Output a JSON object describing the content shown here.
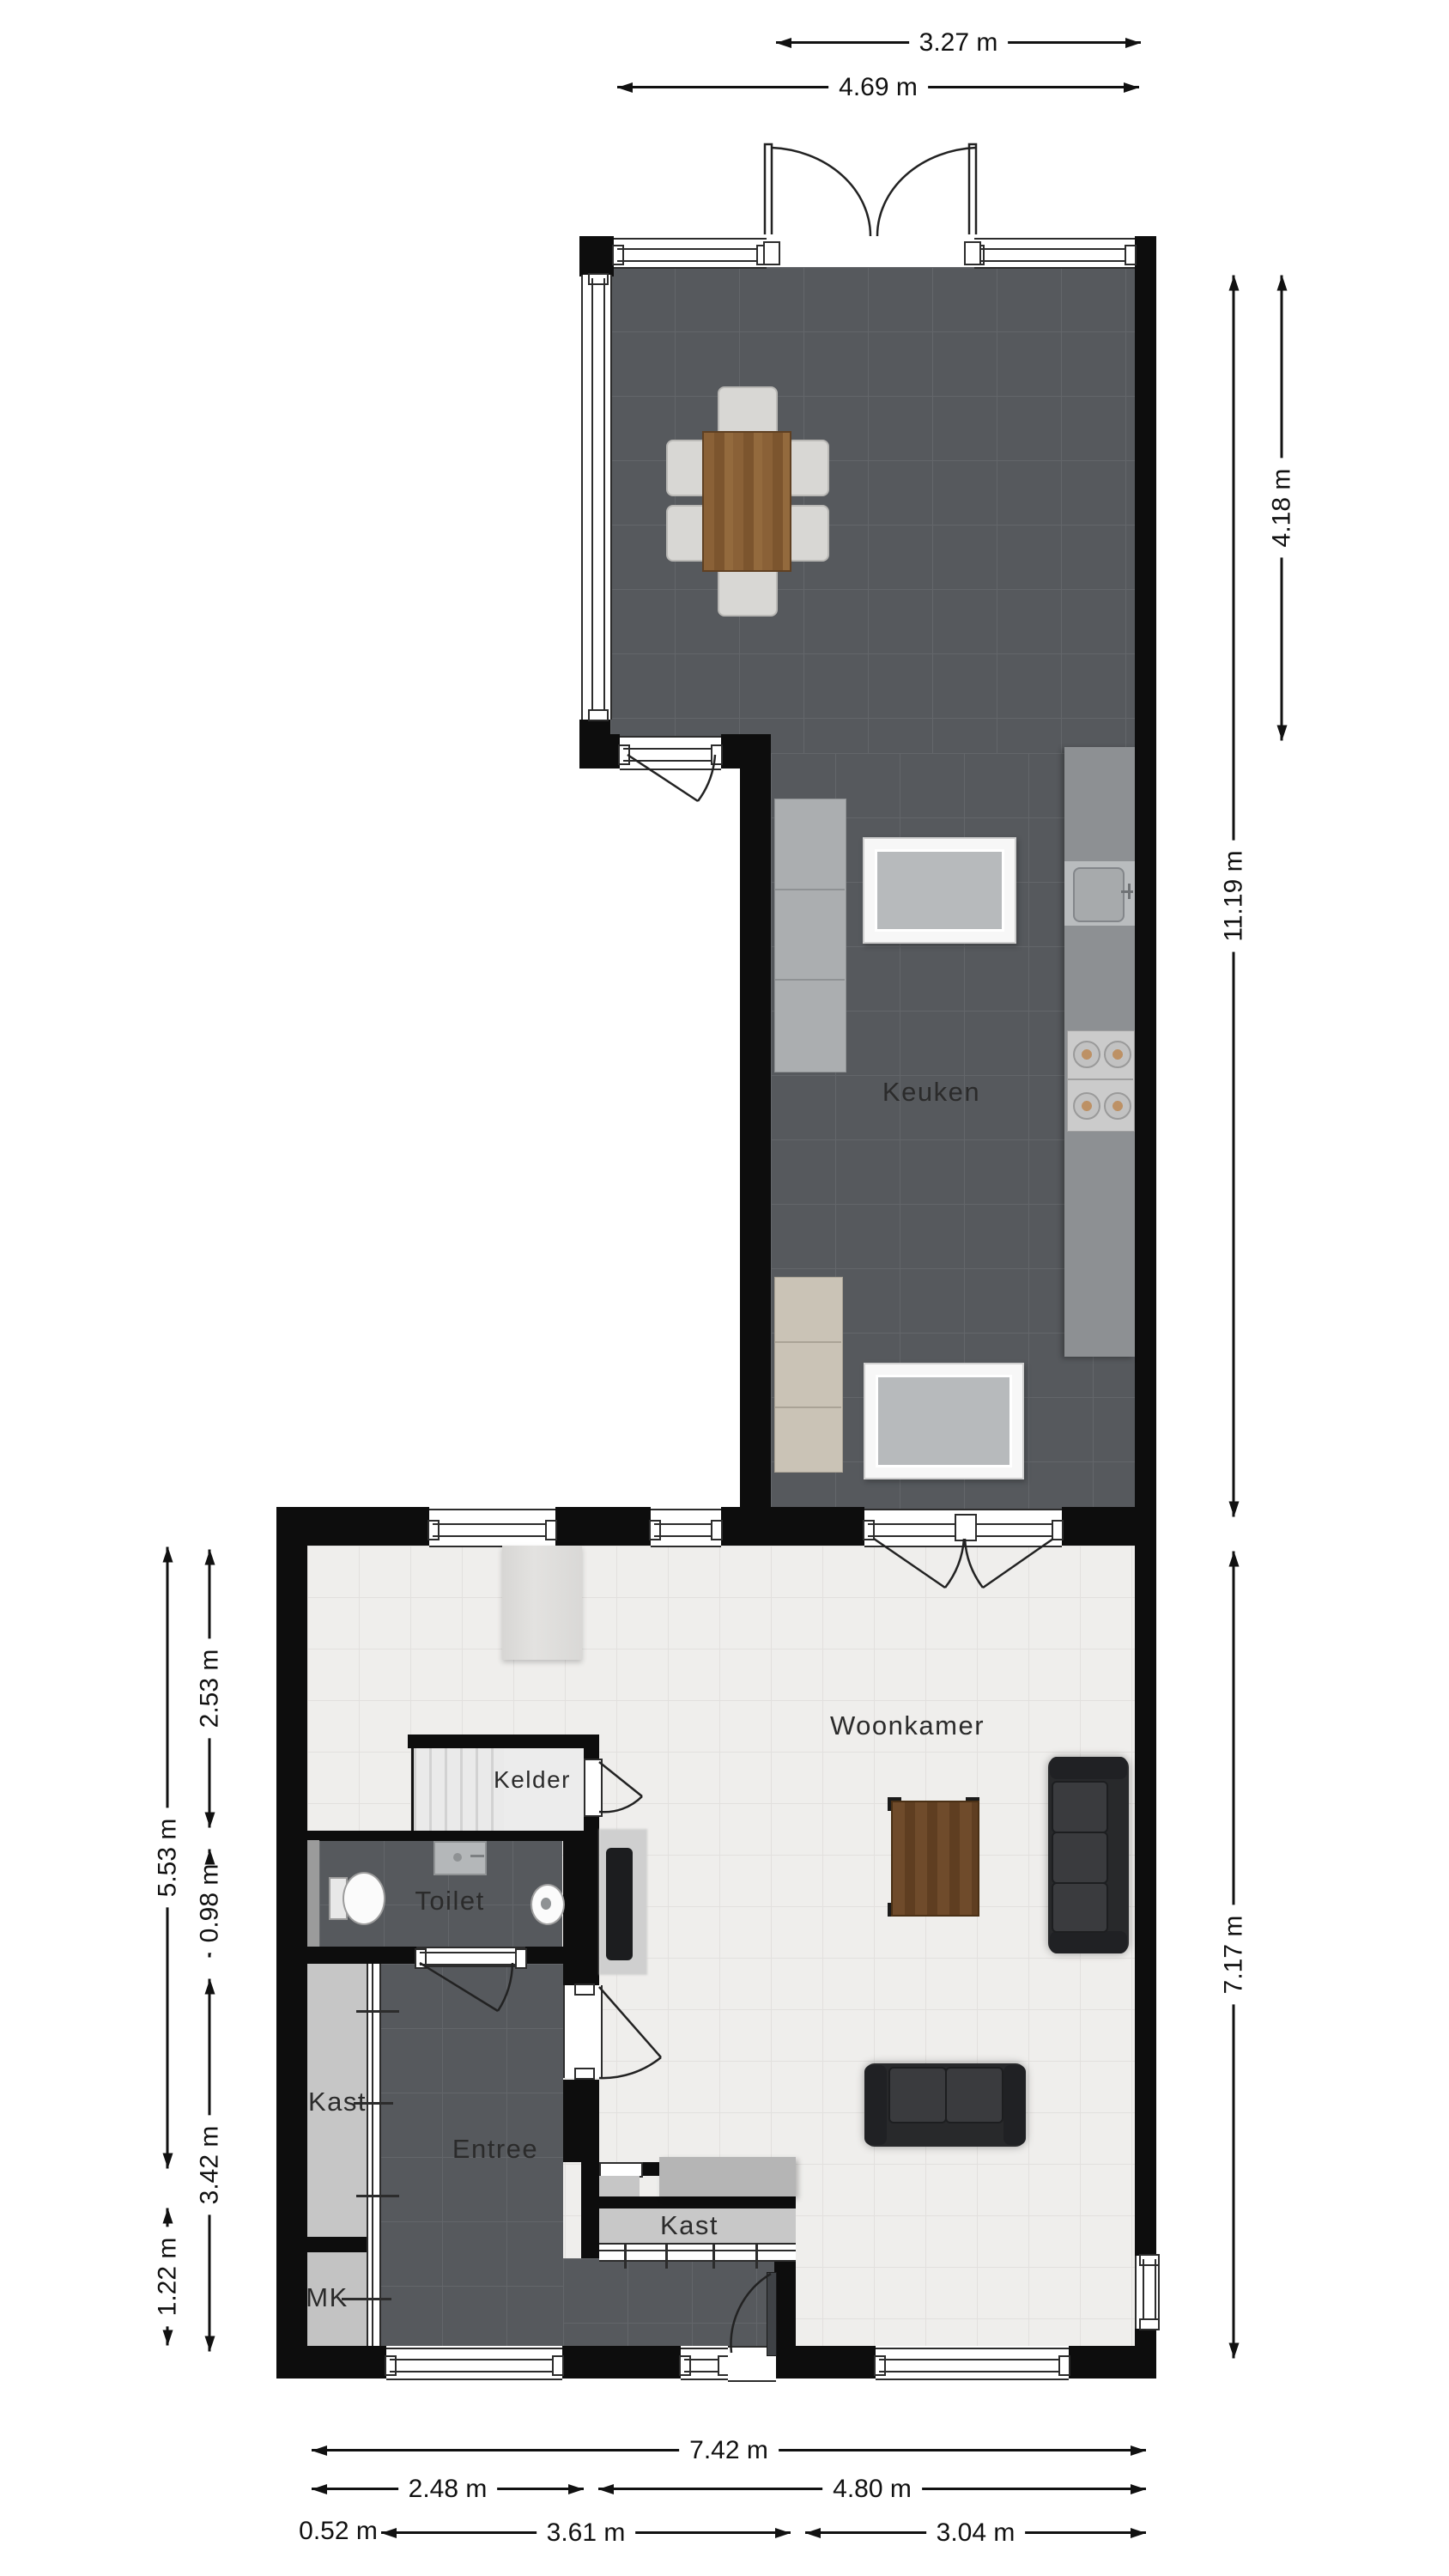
{
  "labels": {
    "keuken": "Keuken",
    "woonkamer": "Woonkamer",
    "kelder": "Kelder",
    "toilet": "Toilet",
    "entree": "Entree",
    "kast_left": "Kast",
    "kast_right": "Kast",
    "mk": "MK"
  },
  "dims": {
    "top_inner": "3.27 m",
    "top_outer": "4.69 m",
    "right_dining": "4.18 m",
    "right_total": "11.19 m",
    "right_living": "7.17 m",
    "left_upper": "5.53 m",
    "left_lower": "1.22 m",
    "left_a": "2.53 m",
    "left_b": "0.98 m",
    "left_c": "3.42 m",
    "bottom_total": "7.42 m",
    "bottom_left": "2.48 m",
    "bottom_right": "4.80 m",
    "bottom_c1": "0.52 m",
    "bottom_c2": "3.61 m",
    "bottom_c3": "3.04 m"
  },
  "colors": {
    "wall": "#0d0d0d",
    "floor_dark": "#56595d",
    "floor_light": "#efeeec",
    "counter": "#8d9093",
    "cabinet_gray": "#abaeb0",
    "cabinet_beige": "#cac3b6",
    "wood": "#8a6137",
    "sofa": "#28292b"
  }
}
